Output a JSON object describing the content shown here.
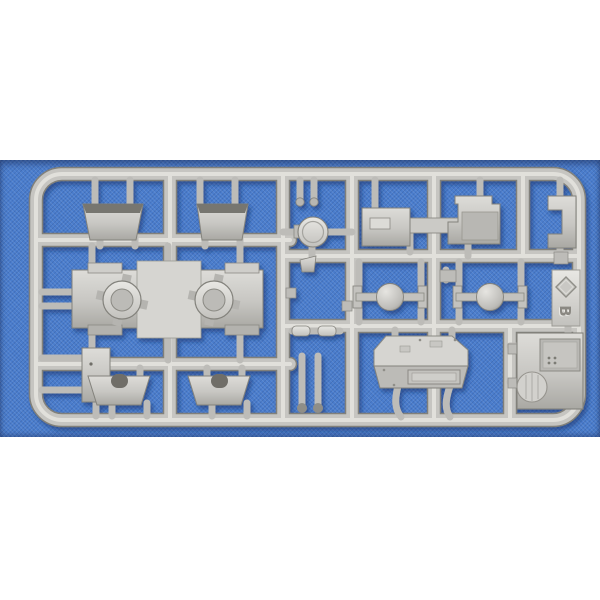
{
  "meta": {
    "description": "Photograph of a light-grey injection-moulded model kit parts sprue (runner) lying on blue woven fabric, centered on a white page"
  },
  "photo": {
    "page_background": "#ffffff",
    "fabric_color": "#4a7dcd",
    "plastic_color": "#c7c6c2",
    "plastic_highlight": "#e4e3df",
    "plastic_shadow": "#8b8a84"
  },
  "sprue": {
    "marking_letter": "B",
    "marking_symbol": "diamond",
    "parts": [
      "stowage-bin",
      "stowage-bin",
      "chassis-plate-with-axle-mounts",
      "mudguard",
      "mudguard",
      "side-sill",
      "side-sill",
      "round-hatch-lid",
      "fender-with-toolbox",
      "corner-bracket",
      "axle-with-differential",
      "axle-with-differential",
      "upper-hull-body",
      "rear-panel-with-hatch",
      "pins-and-small-fittings"
    ]
  }
}
